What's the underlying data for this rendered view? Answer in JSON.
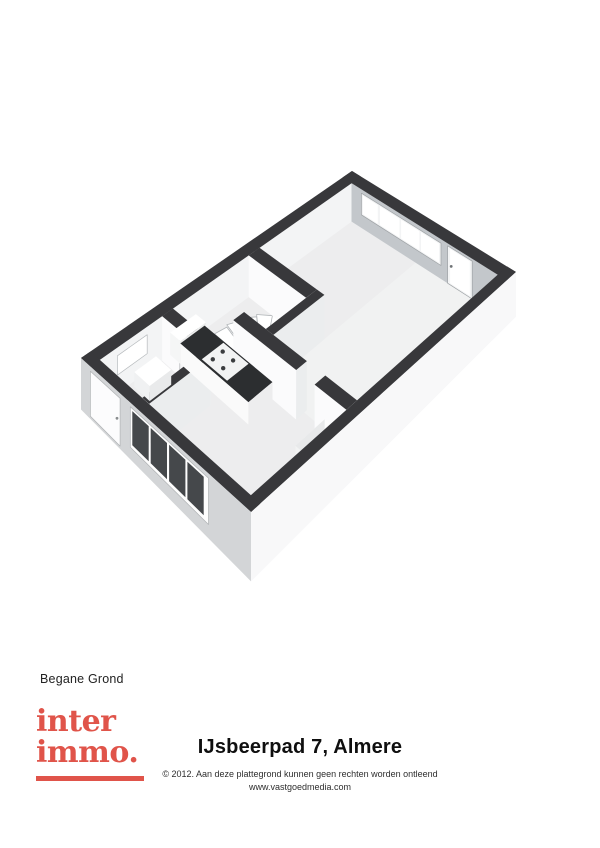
{
  "plan": {
    "label": "Begane Grond",
    "type": "3d-isometric-floorplan",
    "features": [
      "living-room",
      "open-kitchen-with-stove",
      "winder-staircase",
      "toilet",
      "hall",
      "front-door",
      "large-window-with-glass-door"
    ],
    "colors": {
      "wall_top": "#38383b",
      "floor": "#ededee",
      "floor_living": "#f1f2f2",
      "ne_inner_face": "#c3c7cb",
      "nw_inner_face": "#f3f4f5",
      "se_inner_face": "#eef0f1",
      "sw_inner_face": "#f0f1f2",
      "ext_nw": "#c6c8ca",
      "ext_sw": "#d3d5d7",
      "ext_se": "#f8f8f9",
      "partition_face": "#fbfbfc",
      "partition_side": "#ebedee",
      "glass_white": "#ffffff",
      "glass_dark": "#45484b",
      "frame": "#f3f4f5",
      "counter_top": "#2c2e30",
      "stair_tread": "#ffffff",
      "stair_edge": "#b2b6b9"
    }
  },
  "footer": {
    "logo_line1": "inter",
    "logo_line2": "immo.",
    "logo_color": "#e0544a",
    "title": "IJsbeerpad 7, Almere",
    "copyright": "© 2012. Aan deze plattegrond kunnen geen rechten worden ontleend",
    "website": "www.vastgoedmedia.com"
  }
}
